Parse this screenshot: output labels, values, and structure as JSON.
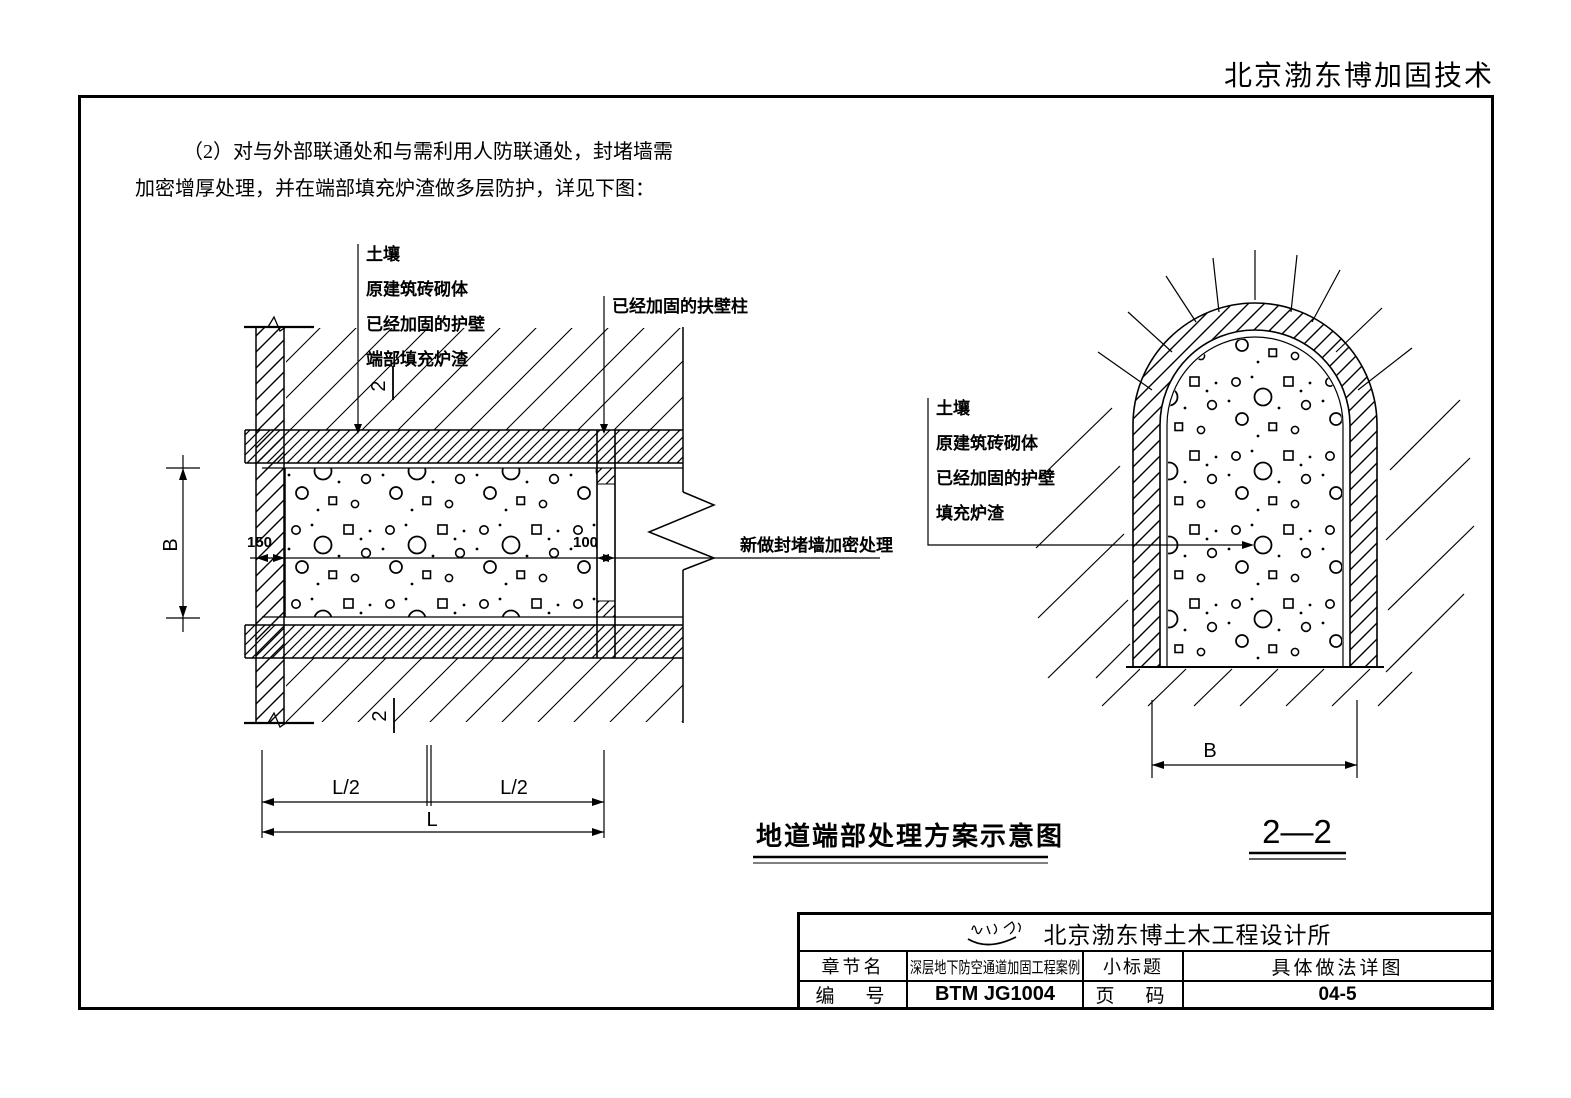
{
  "header": {
    "company": "北京渤东博加固技术"
  },
  "para": {
    "line1": "（2）对与外部联通处和与需利用人防联通处，封堵墙需",
    "line2": "加密增厚处理，并在端部填充炉渣做多层防护，详见下图："
  },
  "left": {
    "labels": {
      "soil": "土壤",
      "masonry": "原建筑砖砌体",
      "lining": "已经加固的护壁",
      "end_fill": "端部填充炉渣",
      "buttress": "已经加固的扶壁柱",
      "seal_note": "新做封堵墙加密处理"
    },
    "dims": {
      "w150": "150",
      "w100": "100",
      "b": "B",
      "l2a": "L/2",
      "l2b": "L/2",
      "l": "L"
    },
    "marks": {
      "top": "2",
      "bottom": "2"
    }
  },
  "right": {
    "labels": {
      "soil": "土壤",
      "masonry": "原建筑砖砌体",
      "lining": "已经加固的护壁",
      "fill": "填充炉渣"
    },
    "dims": {
      "b": "B"
    }
  },
  "captions": {
    "title": "地道端部处理方案示意图",
    "section": "2—2"
  },
  "tblock": {
    "company": "北京渤东博土木工程设计所",
    "chapter_label": "章节名",
    "chapter_value": "深层地下防空通道加固工程案例",
    "subtitle_label": "小标题",
    "subtitle_value": "具体做法详图",
    "number_label": "编　号",
    "number_value": "BTM JG1004",
    "page_label": "页　码",
    "page_value": "04-5"
  }
}
